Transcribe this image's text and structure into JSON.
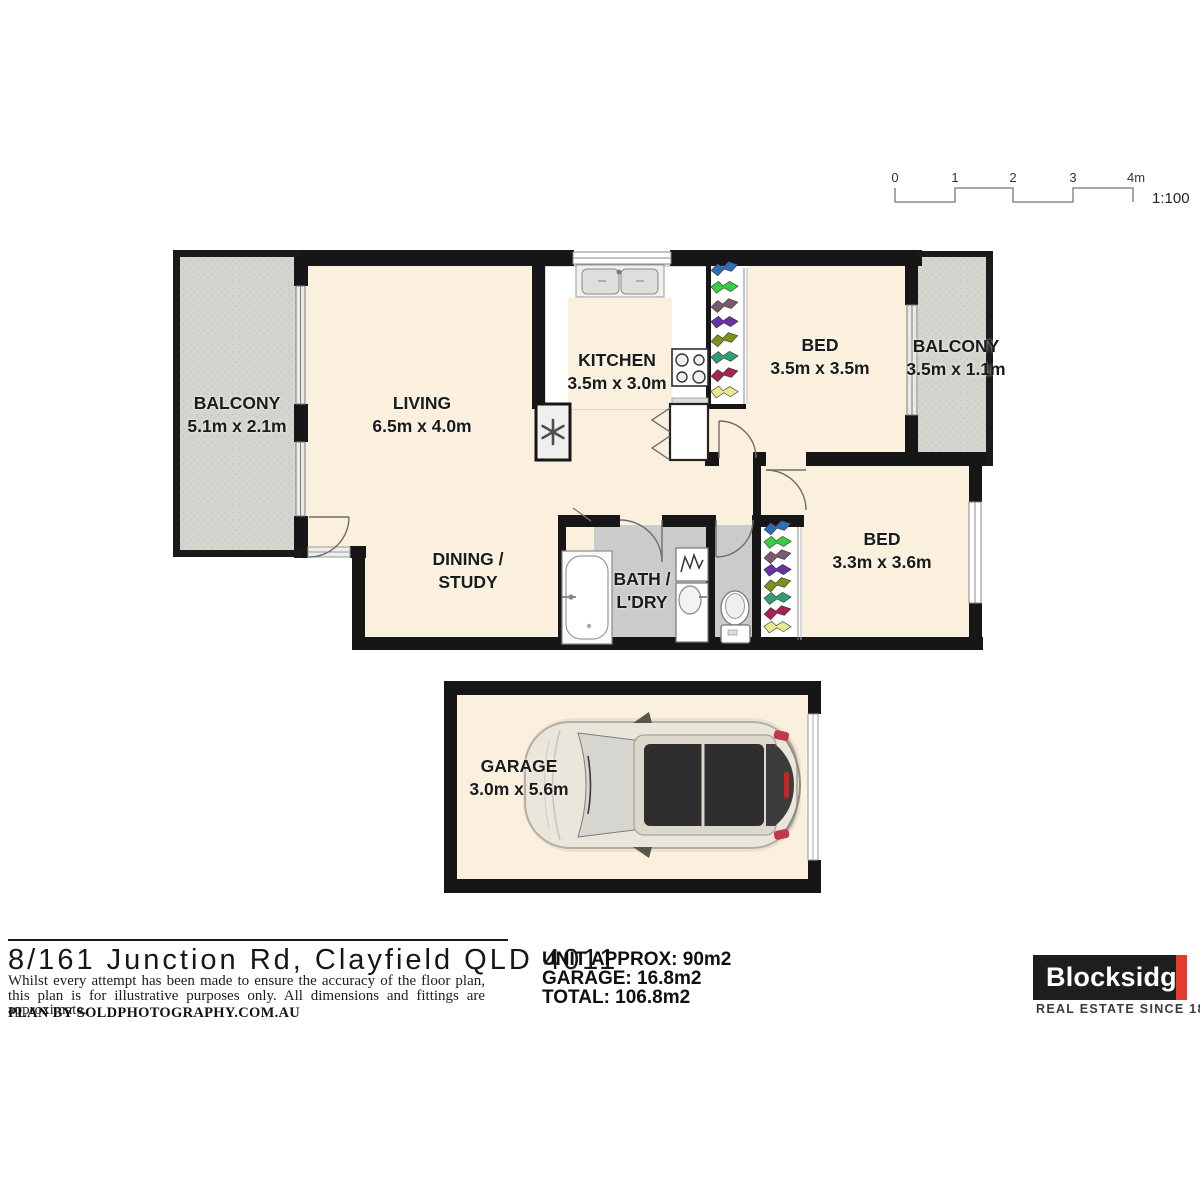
{
  "scale_bar": {
    "ticks": [
      "0",
      "1",
      "2",
      "3",
      "4m"
    ],
    "ratio": "1:100"
  },
  "rooms": {
    "balcony_left": {
      "name": "BALCONY",
      "dims": "5.1m x 2.1m"
    },
    "living": {
      "name": "LIVING",
      "dims": "6.5m x 4.0m"
    },
    "kitchen": {
      "name": "KITCHEN",
      "dims": "3.5m x 3.0m"
    },
    "bed1": {
      "name": "BED",
      "dims": "3.5m x 3.5m"
    },
    "balcony_right": {
      "name": "BALCONY",
      "dims": "3.5m x 1.1m"
    },
    "dining": {
      "line1": "DINING /",
      "line2": "STUDY"
    },
    "bath": {
      "line1": "BATH /",
      "line2": "L'DRY"
    },
    "bed2": {
      "name": "BED",
      "dims": "3.3m x 3.6m"
    },
    "garage": {
      "name": "GARAGE",
      "dims": "3.0m x 5.6m"
    }
  },
  "footer": {
    "address": "8/161 Junction Rd, Clayfield QLD 4011",
    "disclaimer": "Whilst every attempt has been made to ensure the accuracy of the floor plan, this plan is for illustrative purposes only. All dimensions and fittings are approximate.",
    "credit": "PLAN BY SOLDPHOTOGRAPHY.COM.AU",
    "areas": {
      "unit": "UNIT APPROX: 90m2",
      "garage": "GARAGE: 16.8m2",
      "total": "TOTAL: 106.8m2"
    },
    "brand": {
      "name": "Blocksidge",
      "tagline": "REAL ESTATE SINCE 1888",
      "accent_color": "#e8392e"
    }
  },
  "colors": {
    "wall": "#161616",
    "floor_cream": "#faf0dd",
    "balcony_grey": "#d5d4cf",
    "bath_grey": "#cbcbcb"
  },
  "wardrobe_colors": [
    "#2e6cb5",
    "#36cf44",
    "#7b5a70",
    "#6a30a6",
    "#7e8f1d",
    "#2f9f70",
    "#aa2155",
    "#e9e88f"
  ]
}
